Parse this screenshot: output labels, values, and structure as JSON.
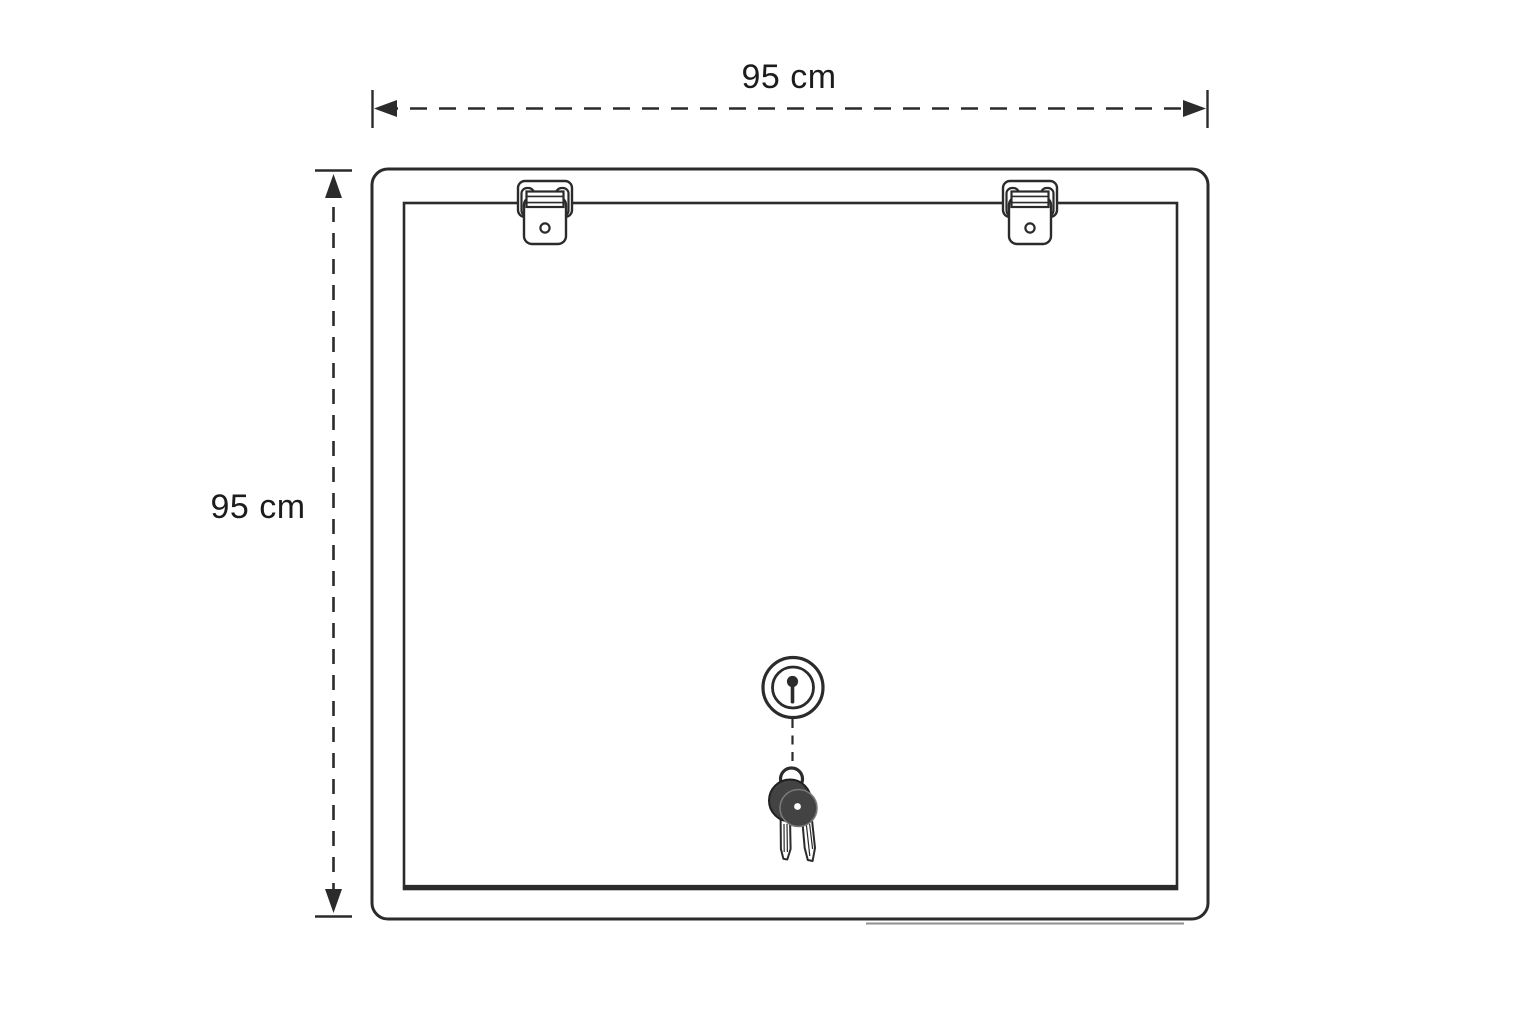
{
  "diagram": {
    "width_dimension": {
      "label": "95 cm"
    },
    "height_dimension": {
      "label": "95 cm"
    },
    "hinge_count": 2,
    "colors": {
      "background": "#ffffff",
      "line": "#2b2b2b",
      "label": "#1c1c1c",
      "keyhead": "#434343",
      "keyrim": "#787878",
      "shadow": "#8f8f8f"
    }
  }
}
